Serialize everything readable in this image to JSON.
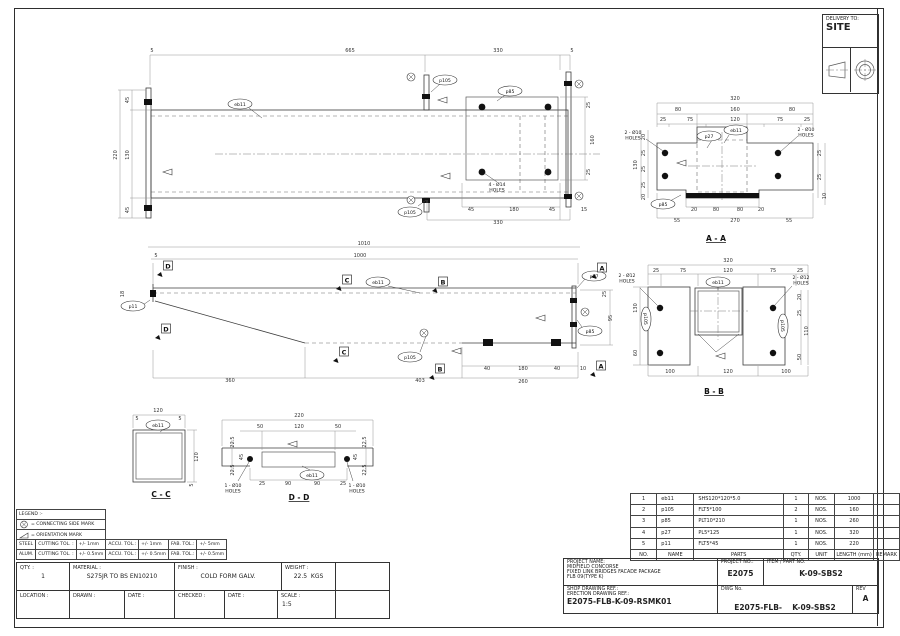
{
  "delivery": {
    "label": "DELIVERY TO:",
    "value": "SITE"
  },
  "legend": {
    "title": "LEGEND :-",
    "items": [
      {
        "icon": "connecting-side-mark",
        "text": "= CONNECTING SIDE MARK"
      },
      {
        "icon": "orientation-mark",
        "text": "= ORIENTATION MARK"
      }
    ]
  },
  "tolerances": {
    "rows": [
      [
        "STEEL",
        "CUTTING TOL. :",
        "+/- 1mm",
        "ACCU. TOL.:",
        "+/- 1mm",
        "FAB. TOL.:",
        "+/- 5mm"
      ],
      [
        "ALUM.",
        "CUTTING TOL. :",
        "+/- 0.5mm",
        "ACCU. TOL.:",
        "+/- 0.5mm",
        "FAB. TOL.:",
        "+/- 0.5mm"
      ]
    ]
  },
  "title_block_left": {
    "qty_label": "QTY. :",
    "qty": "1",
    "material_label": "MATERIAL :",
    "material": "S275JR TO BS EN10210",
    "finish_label": "FINISH :",
    "finish": "COLD FORM GALV.",
    "weight_label": "WEIGHT :",
    "weight": "22.5",
    "weight_unit": "KGS",
    "location_label": "LOCATION :",
    "drawn_label": "DRAWN :",
    "date1_label": "DATE :",
    "checked_label": "CHECKED :",
    "date2_label": "DATE :",
    "scale_label": "SCALE :",
    "scale": "1:5"
  },
  "parts_table": {
    "headers": [
      "NO.",
      "NAME",
      "PARTS",
      "QTY.",
      "UNIT",
      "LENGTH (mm)",
      "REMARK"
    ],
    "rows": [
      [
        "1",
        "eb11",
        "SHS120*120*5.0",
        "1",
        "NOS.",
        "1000",
        ""
      ],
      [
        "2",
        "p105",
        "FLT5*100",
        "2",
        "NOS.",
        "160",
        ""
      ],
      [
        "3",
        "p85",
        "PLT10*210",
        "1",
        "NOS.",
        "260",
        ""
      ],
      [
        "4",
        "p27",
        "PL5*125",
        "1",
        "NOS.",
        "320",
        ""
      ],
      [
        "5",
        "p11",
        "FLT5*45",
        "1",
        "NOS.",
        "220",
        ""
      ]
    ]
  },
  "title_block_right": {
    "project_name_label": "PROJECT NAME:",
    "project_name_lines": [
      "MIDFIELD CONCORSE",
      "FIXED LINK BRIDGES FACADE PACKAGE",
      "FLB 09(TYPE K)"
    ],
    "project_no_label": "PROJECT NO.:",
    "project_no": "E2075",
    "item_label": "ITEM / PART NO.",
    "item": "K-09-SBS2",
    "shop_ref_label": "SHOP DRAWING REF.:",
    "erection_ref_label": "ERECTION DRAWING REF.:",
    "shop_ref": "E2075-FLB-K-09-RSMK01",
    "dwg_label": "DWG No.",
    "dwg_no": "E2075-FLB-",
    "dwg_no2": "K-09-SBS2",
    "rev_label": "REV",
    "rev": "A"
  },
  "drawing": {
    "section_titles": [
      [
        716,
        241,
        "A - A"
      ],
      [
        714,
        394,
        "B - B"
      ],
      [
        161,
        497,
        "C - C"
      ],
      [
        299,
        500,
        "D - D"
      ]
    ],
    "markers": [
      [
        168,
        266,
        "D"
      ],
      [
        166,
        329,
        "D"
      ],
      [
        347,
        280,
        "C"
      ],
      [
        344,
        352,
        "C"
      ],
      [
        443,
        282,
        "B"
      ],
      [
        440,
        369,
        "B"
      ],
      [
        602,
        268,
        "A"
      ],
      [
        601,
        366,
        "A"
      ]
    ],
    "balloons": [
      [
        240,
        104,
        "eb11"
      ],
      [
        445,
        80,
        "p105"
      ],
      [
        410,
        212,
        "p105"
      ],
      [
        510,
        91,
        "p85"
      ],
      [
        133,
        306,
        "p11"
      ],
      [
        378,
        282,
        "eb11"
      ],
      [
        410,
        357,
        "p105"
      ],
      [
        594,
        276,
        "p27"
      ],
      [
        590,
        331,
        "p85"
      ],
      [
        709,
        136,
        "p27"
      ],
      [
        736,
        130,
        "eb11"
      ],
      [
        663,
        204,
        "p85"
      ],
      [
        718,
        282,
        "eb11"
      ],
      [
        646,
        319,
        "p105",
        90
      ],
      [
        783,
        326,
        "p105",
        90
      ],
      [
        158,
        425,
        "eb11"
      ],
      [
        312,
        475,
        "eb11"
      ]
    ],
    "notes": [
      [
        497,
        186,
        [
          "4 - Ø14",
          "HOLES"
        ]
      ],
      [
        633,
        134,
        [
          "2 - Ø10",
          "HOLES"
        ]
      ],
      [
        806,
        131,
        [
          "2 - Ø10",
          "HOLES"
        ]
      ],
      [
        627,
        277,
        [
          "2 - Ø12",
          "HOLES"
        ]
      ],
      [
        801,
        279,
        [
          "2 - Ø12",
          "HOLES"
        ]
      ],
      [
        233,
        487,
        [
          "1 - Ø10",
          "HOLES"
        ]
      ],
      [
        357,
        487,
        [
          "1 - Ø10",
          "HOLES"
        ]
      ]
    ],
    "dims": [
      [
        152,
        52,
        "5"
      ],
      [
        350,
        52,
        "665"
      ],
      [
        498,
        52,
        "330"
      ],
      [
        572,
        52,
        "5"
      ],
      [
        117,
        155,
        "220",
        -90
      ],
      [
        129,
        100,
        "45",
        -90
      ],
      [
        129,
        155,
        "130",
        -90
      ],
      [
        129,
        210,
        "45",
        -90
      ],
      [
        471,
        211,
        "45"
      ],
      [
        514,
        211,
        "180"
      ],
      [
        552,
        211,
        "45"
      ],
      [
        498,
        224,
        "330"
      ],
      [
        584,
        211,
        "15"
      ],
      [
        590,
        105,
        "25",
        -90
      ],
      [
        594,
        140,
        "160",
        -90
      ],
      [
        590,
        172,
        "25",
        -90
      ],
      [
        364,
        245,
        "1010"
      ],
      [
        360,
        257,
        "1000"
      ],
      [
        156,
        257,
        "5"
      ],
      [
        124,
        294,
        "18",
        -90
      ],
      [
        230,
        382,
        "360"
      ],
      [
        420,
        382,
        "403"
      ],
      [
        487,
        370,
        "40"
      ],
      [
        523,
        370,
        "180"
      ],
      [
        557,
        370,
        "40"
      ],
      [
        523,
        383,
        "260"
      ],
      [
        583,
        370,
        "10"
      ],
      [
        612,
        318,
        "95",
        -90
      ],
      [
        606,
        294,
        "25",
        -90
      ],
      [
        735,
        100,
        "320"
      ],
      [
        678,
        111,
        "80"
      ],
      [
        735,
        111,
        "160"
      ],
      [
        792,
        111,
        "80"
      ],
      [
        663,
        121,
        "25"
      ],
      [
        690,
        121,
        "75"
      ],
      [
        735,
        121,
        "120"
      ],
      [
        780,
        121,
        "75"
      ],
      [
        807,
        121,
        "25"
      ],
      [
        645,
        137,
        "20",
        -90
      ],
      [
        645,
        153,
        "25",
        -90
      ],
      [
        645,
        169,
        "25",
        -90
      ],
      [
        645,
        185,
        "25",
        -90
      ],
      [
        645,
        197,
        "20",
        -90
      ],
      [
        637,
        165,
        "130",
        -90
      ],
      [
        821,
        153,
        "25",
        -90
      ],
      [
        821,
        177,
        "25",
        -90
      ],
      [
        826,
        196,
        "10",
        -90
      ],
      [
        694,
        211,
        "20"
      ],
      [
        716,
        211,
        "80"
      ],
      [
        740,
        211,
        "80"
      ],
      [
        761,
        211,
        "20"
      ],
      [
        677,
        222,
        "55"
      ],
      [
        789,
        222,
        "55"
      ],
      [
        735,
        222,
        "270"
      ],
      [
        728,
        262,
        "320"
      ],
      [
        656,
        272,
        "25"
      ],
      [
        683,
        272,
        "75"
      ],
      [
        728,
        272,
        "120"
      ],
      [
        773,
        272,
        "75"
      ],
      [
        800,
        272,
        "25"
      ],
      [
        637,
        308,
        "130",
        -90
      ],
      [
        637,
        353,
        "60",
        -90
      ],
      [
        801,
        297,
        "20",
        -90
      ],
      [
        801,
        313,
        "25",
        -90
      ],
      [
        808,
        331,
        "110",
        -90
      ],
      [
        801,
        357,
        "50",
        -90
      ],
      [
        670,
        373,
        "100"
      ],
      [
        728,
        373,
        "120"
      ],
      [
        786,
        373,
        "100"
      ],
      [
        158,
        412,
        "120"
      ],
      [
        198,
        457,
        "120",
        -90
      ],
      [
        137,
        420,
        "5"
      ],
      [
        180,
        420,
        "5"
      ],
      [
        193,
        485,
        "5",
        -90
      ],
      [
        299,
        417,
        "220"
      ],
      [
        260,
        428,
        "50"
      ],
      [
        299,
        428,
        "120"
      ],
      [
        338,
        428,
        "50"
      ],
      [
        234,
        442,
        "22.5",
        -90
      ],
      [
        234,
        470,
        "22.5",
        -90
      ],
      [
        243,
        457,
        "45",
        -90
      ],
      [
        366,
        442,
        "22.5",
        -90
      ],
      [
        366,
        470,
        "22.5",
        -90
      ],
      [
        357,
        457,
        "45",
        -90
      ],
      [
        262,
        485,
        "25"
      ],
      [
        288,
        485,
        "90"
      ],
      [
        317,
        485,
        "90"
      ],
      [
        343,
        485,
        "25"
      ]
    ],
    "connecting_marks": [
      [
        411,
        77
      ],
      [
        411,
        200
      ],
      [
        579,
        84
      ],
      [
        579,
        196
      ],
      [
        585,
        312
      ],
      [
        424,
        333
      ]
    ],
    "orientation_marks": [
      [
        163,
        172
      ],
      [
        438,
        100
      ],
      [
        441,
        176
      ],
      [
        452,
        351
      ],
      [
        536,
        318
      ],
      [
        677,
        163
      ],
      [
        716,
        356
      ],
      [
        288,
        444
      ]
    ]
  }
}
